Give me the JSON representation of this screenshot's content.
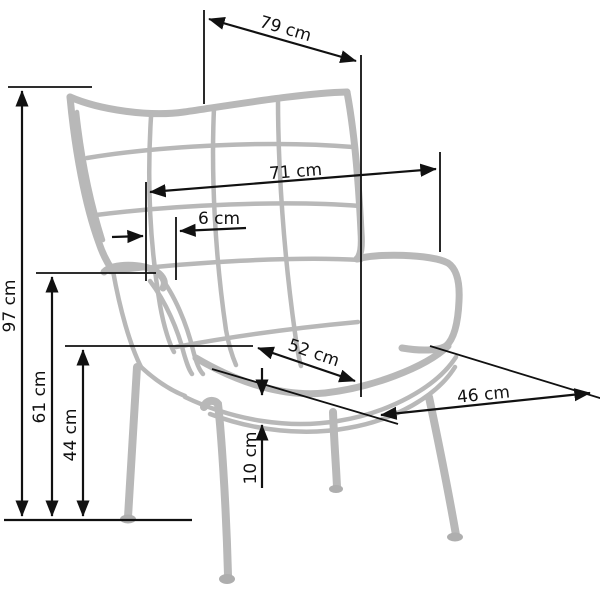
{
  "drawing": {
    "subject": "wingback armchair dimensioned line drawing",
    "unit": "cm",
    "colors": {
      "background": "#ffffff",
      "chair_outline": "#b8b8b8",
      "dimension_lines": "#111111"
    },
    "labels": {
      "top_depth": "79 cm",
      "back_width": "71 cm",
      "tuft_spacing": "6 cm",
      "seat_depth": "52 cm",
      "seat_front_width": "46 cm",
      "total_height": "97 cm",
      "arm_height": "61 cm",
      "seat_height": "44 cm",
      "cushion_thickness": "10 cm"
    }
  }
}
